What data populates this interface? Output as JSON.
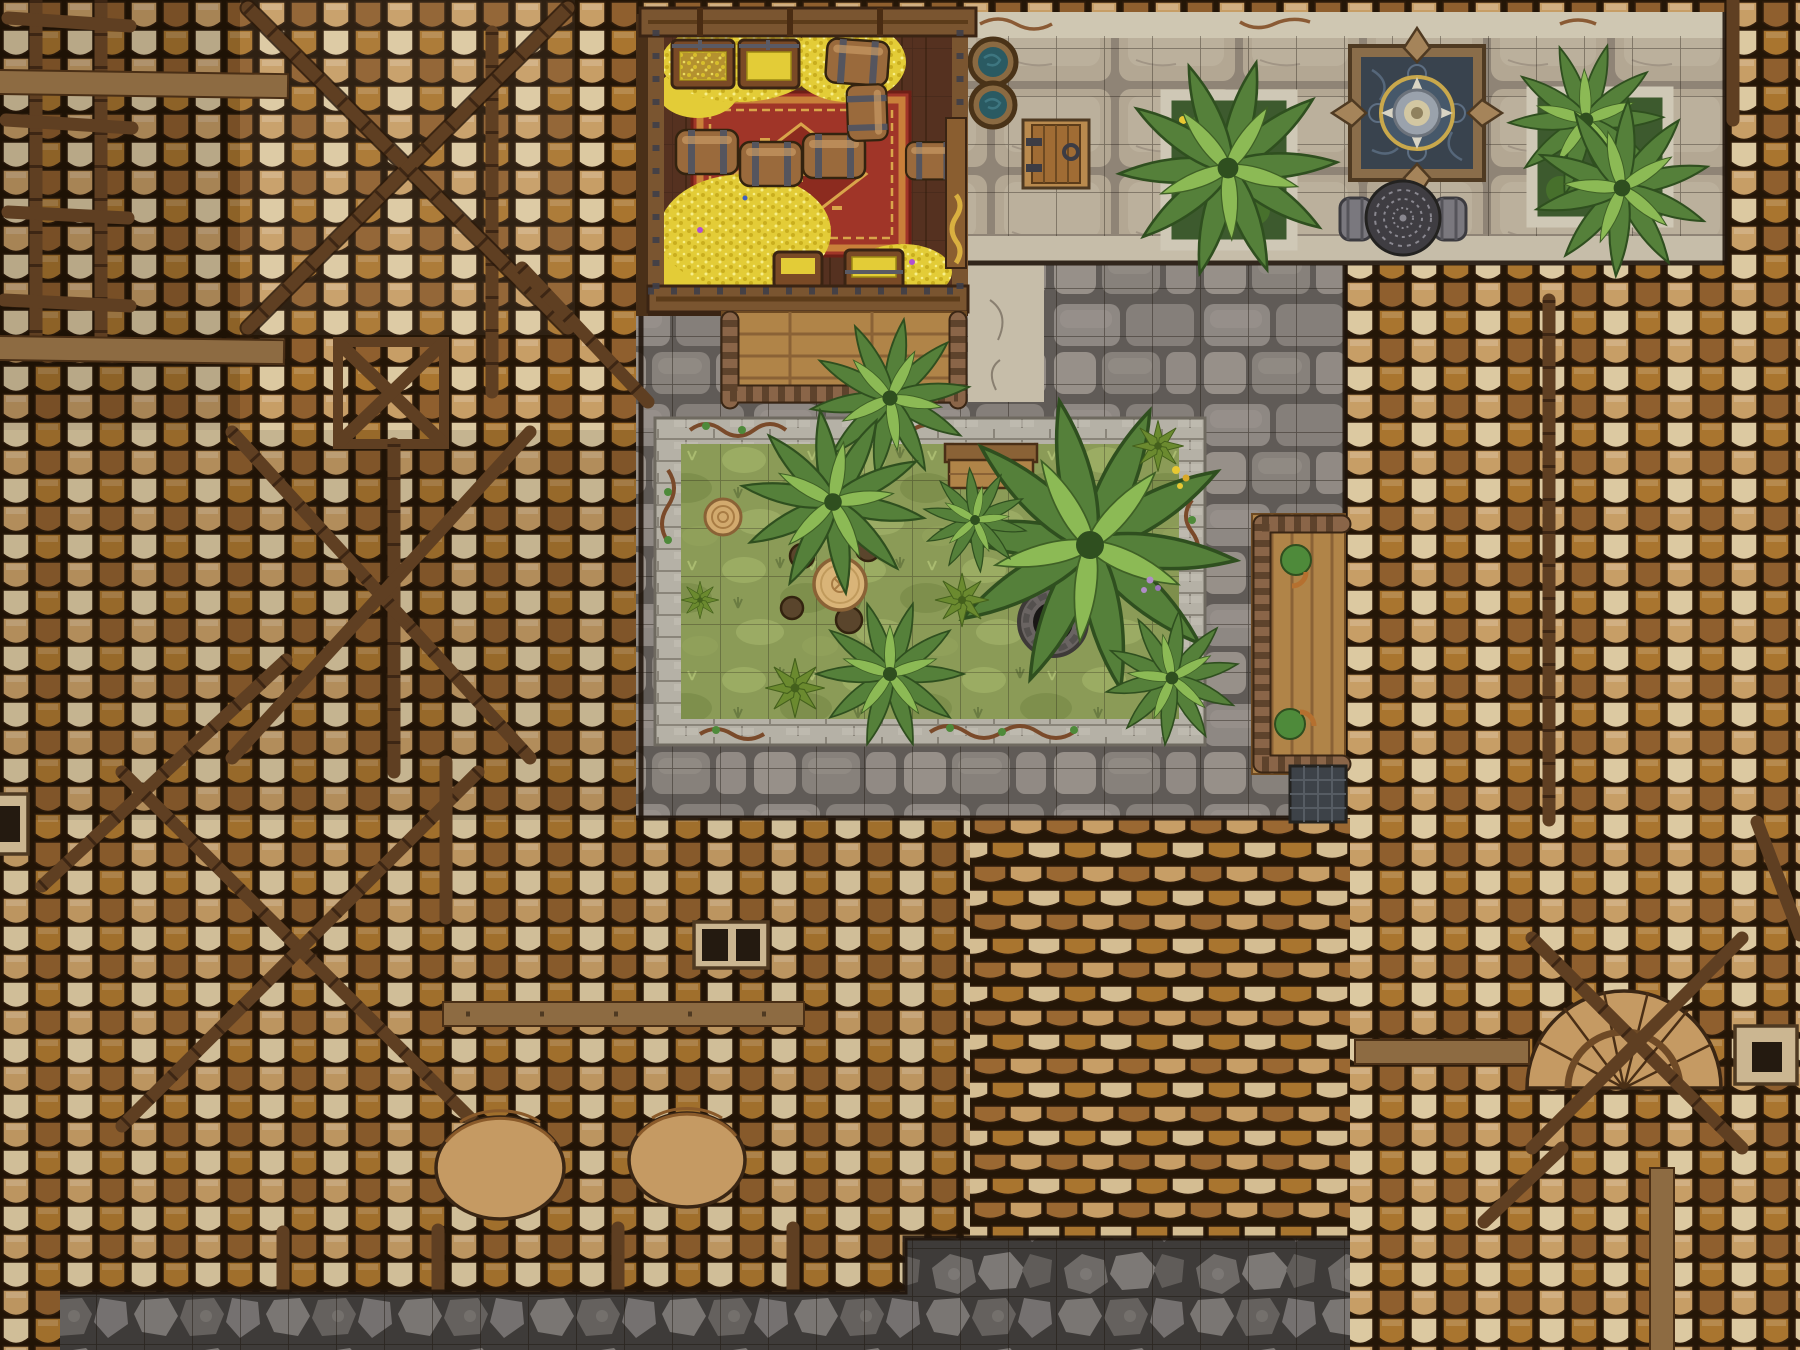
{
  "scene": {
    "type": "top-down fantasy battlemap of a walled villa with tiled rooftops, courtyard garden, terrace and treasure room",
    "grid_size_px": 48,
    "regions": {
      "treasure_room": {
        "label": "treasure room",
        "objects": [
          "gold coin piles",
          "open chest of gold",
          "open chest of gold",
          "closed gold chest",
          "small gold chest",
          "wooden barrels",
          "red patterned carpet with diamond medallion",
          "golden door latch on east wall"
        ]
      },
      "terrace": {
        "label": "stone terrace walk",
        "objects": [
          "water barrel",
          "water barrel",
          "wooden cellar trapdoor with ring handle",
          "stone planter with tropical plants",
          "square fountain pool with compass spout",
          "wrought-iron lace table with two stools",
          "stone planter with tropical plants"
        ]
      },
      "courtyard": {
        "label": "grey cobblestone courtyard"
      },
      "garden": {
        "label": "walled garden bed",
        "objects": [
          "wooden bench",
          "round wooden table with stump stools",
          "stone well",
          "tree stump",
          "palm plants",
          "spiky shrubs",
          "yellow flowers",
          "purple flowers",
          "vine-covered low wall"
        ]
      },
      "walkway": {
        "label": "vine-framed wooden walkway"
      },
      "balcony": {
        "label": "vine-framed wooden balcony landing"
      },
      "roofs": {
        "label": "terracotta tiled rooftops",
        "features": [
          "crossed ridge beams",
          "roof ladder",
          "wooden planks",
          "chimney with twin flues",
          "small chimneys",
          "dark skylight hatch",
          "two domed dormers",
          "fan-shaped dormer",
          "bamboo-jointed rafters"
        ]
      },
      "pavement": {
        "label": "dark cobble pavement with grid"
      }
    }
  },
  "palette": {
    "roof_gap": "#241607",
    "roof_tile_light": "#dcc9a1",
    "roof_tile_tan": "#c79e66",
    "roof_tile_orange": "#a9752f",
    "roof_tile_brown": "#8f5f2e",
    "beam_dark": "#5f3f22",
    "beam_light": "#8d6b42",
    "cobble_base": "#605b57",
    "cobble_stone": "#938d88",
    "terrace_base": "#8f8476",
    "terrace_slab": "#b3a793",
    "terrace_band": "#cfc7b2",
    "stone_wall": "#b5b1a6",
    "grass": "#8b9b57",
    "grass_light": "#a3b269",
    "leaf_dark": "#55803a",
    "leaf_light": "#8cba55",
    "gold": "#e3cc37",
    "carpet": "#a03528",
    "carpet_trim": "#d9a54a",
    "wood_floor": "#553120",
    "wood_wall": "#7a5530",
    "wood_plank": "#b08448",
    "rope": "#8a6548",
    "water": "#2a5a62",
    "fountain_water": "#39434e",
    "fountain_frame": "#8a6d4a",
    "fountain_gold": "#c9a84c",
    "iron": "#3f3d42",
    "well_stone": "#6a6462",
    "rubble_base": "#3e3b39",
    "rubble_stone": "#6e6a67",
    "stump": "#d2aa6e",
    "table_wood": "#d9b478"
  }
}
